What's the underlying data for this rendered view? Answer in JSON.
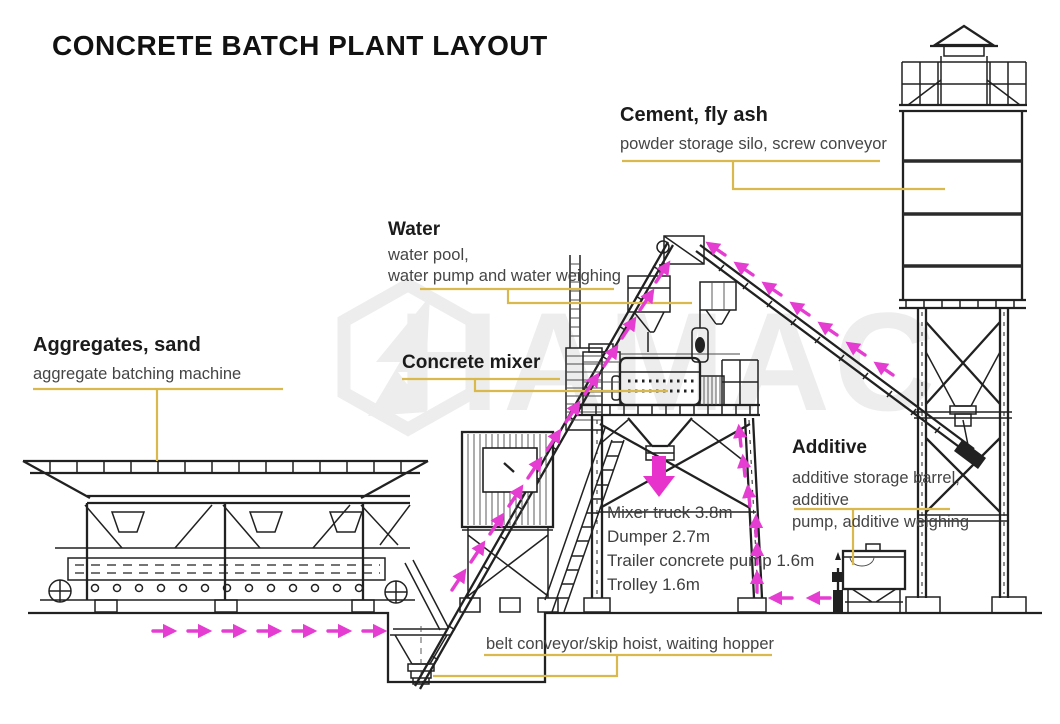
{
  "title": "CONCRETE BATCH PLANT LAYOUT",
  "watermark": {
    "text": "HAMAC"
  },
  "labels": {
    "cement": {
      "heading": "Cement, fly ash",
      "description": "powder storage silo, screw conveyor"
    },
    "water": {
      "heading": "Water",
      "description_line1": "water pool,",
      "description_line2": "water pump and water weighing"
    },
    "aggregates": {
      "heading": "Aggregates, sand",
      "description": "aggregate batching machine"
    },
    "concrete_mixer": {
      "heading": "Concrete mixer"
    },
    "additive": {
      "heading": "Additive",
      "description_line1": "additive storage barrel, additive",
      "description_line2": "pump, additive weighing"
    },
    "belt_conveyor": {
      "description": "belt conveyor/skip hoist, waiting hopper"
    },
    "clearances": [
      "Mixer truck 3.8m",
      "Dumper 2.7m",
      "Trailer concrete pump 1.6m",
      "Trolley 1.6m"
    ]
  },
  "colors": {
    "background": "#ffffff",
    "line": "#212121",
    "connector_line": "#d9b84e",
    "flow_arrow": "#e53dd2",
    "heading_text": "#1b1b1b",
    "body_text": "#454545",
    "watermark": "#ededed"
  }
}
